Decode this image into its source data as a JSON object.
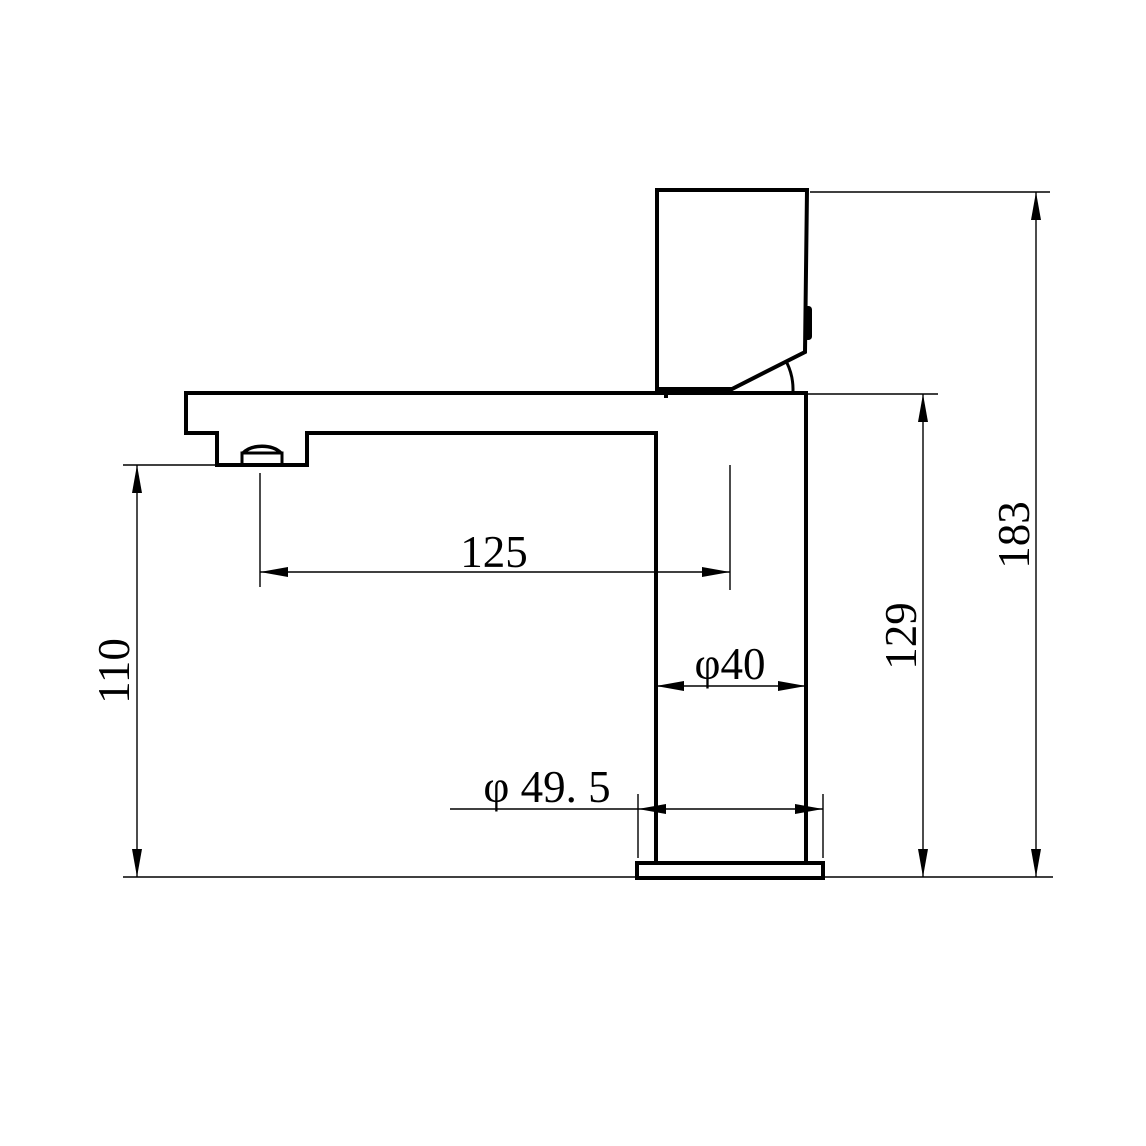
{
  "drawing": {
    "subject": "basin faucet side elevation technical drawing",
    "units": "mm",
    "background_color": "#ffffff",
    "line_color": "#000000",
    "dims": {
      "spout_reach": {
        "label": "125",
        "value": 125,
        "orientation": "horizontal"
      },
      "outlet_height": {
        "label": "110",
        "value": 110,
        "orientation": "vertical"
      },
      "body_diameter": {
        "label": "φ40",
        "value": 40,
        "orientation": "horizontal"
      },
      "base_diameter": {
        "label": "φ 49. 5",
        "value": 49.5,
        "orientation": "horizontal"
      },
      "spout_height": {
        "label": "129",
        "value": 129,
        "orientation": "vertical"
      },
      "overall_height": {
        "label": "183",
        "value": 183,
        "orientation": "vertical"
      }
    }
  }
}
